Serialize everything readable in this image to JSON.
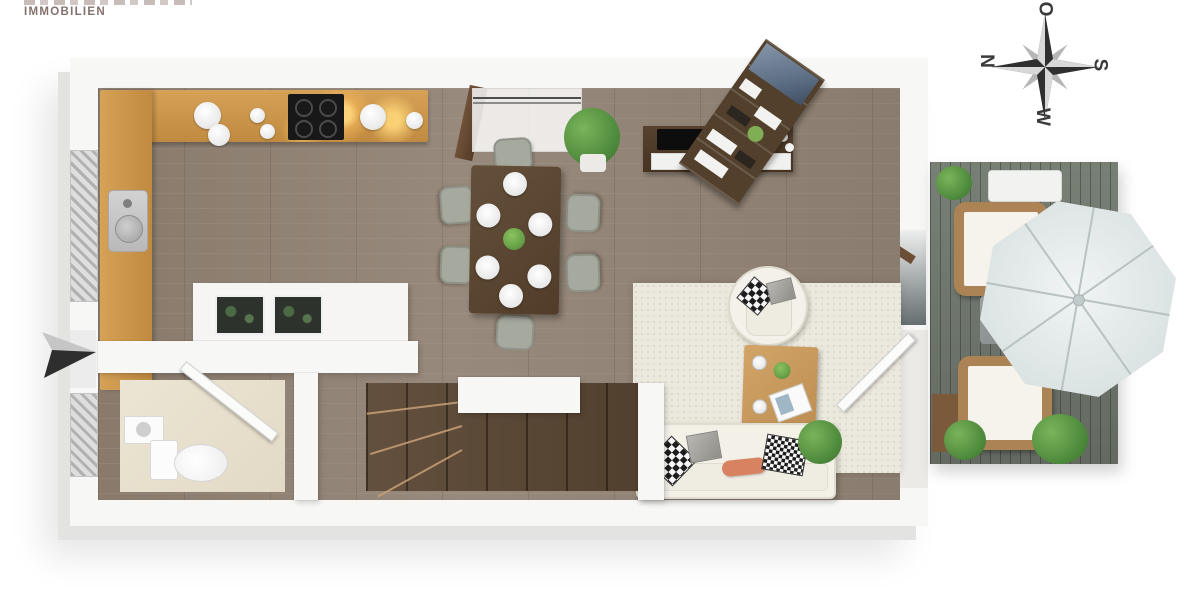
{
  "branding": {
    "company_line": "IMMOBILIEN"
  },
  "compass": {
    "top": "O",
    "right": "S",
    "bottom": "W",
    "left": "N"
  },
  "palette": {
    "background": "#ffffff",
    "wall": "#f7f7f6",
    "wall_shadow": "#e3e3e2",
    "floor_wood": "#8d7e70",
    "stair_wood": "#5a4636",
    "terrace_deck": "#6f746d",
    "kitchen_counter": "#cf9a4d",
    "counter_glow": "#ffd678",
    "dining_table": "#5b4530",
    "chair_gray": "#a6a99e",
    "rug": "#ebe8dd",
    "sofa_cream": "#f3f0e8",
    "coffee_table": "#c79a5e",
    "pillow_orange": "#d9825f",
    "plant_green": "#4e8a3c",
    "umbrella": "#e3e9e9",
    "rattan": "#ab8354",
    "compass_ink": "#3a3a3a",
    "logo_ink": "#84716d"
  },
  "floorplan": {
    "style": "3d-top-down-render",
    "rooms": [
      {
        "name": "kitchen",
        "features": [
          "l-shaped-counter",
          "cooktop",
          "sink",
          "kitchen-island",
          "plate-stacks",
          "bowls",
          "under-cabinet-lighting",
          "window"
        ]
      },
      {
        "name": "dining-area",
        "features": [
          "dining-table",
          "six-chairs",
          "six-place-settings",
          "centerpiece",
          "potted-plant"
        ]
      },
      {
        "name": "living-area",
        "features": [
          "tv-sideboard",
          "flat-tv",
          "diagonal-shelf-unit",
          "wall-art",
          "rug",
          "sofa",
          "throw-pillows",
          "coffee-table",
          "armchair",
          "plants",
          "glass-door-to-terrace"
        ]
      },
      {
        "name": "wc-bathroom",
        "features": [
          "toilet",
          "washbasin",
          "open-door",
          "window"
        ]
      },
      {
        "name": "staircase",
        "features": [
          "winder-stairs",
          "white-landing"
        ]
      },
      {
        "name": "terrace",
        "features": [
          "wood-deck",
          "two-rattan-armchairs",
          "side-table",
          "lounger",
          "parasol",
          "planter",
          "plants"
        ]
      }
    ],
    "annotations": [
      "entrance-arrow-left"
    ]
  }
}
